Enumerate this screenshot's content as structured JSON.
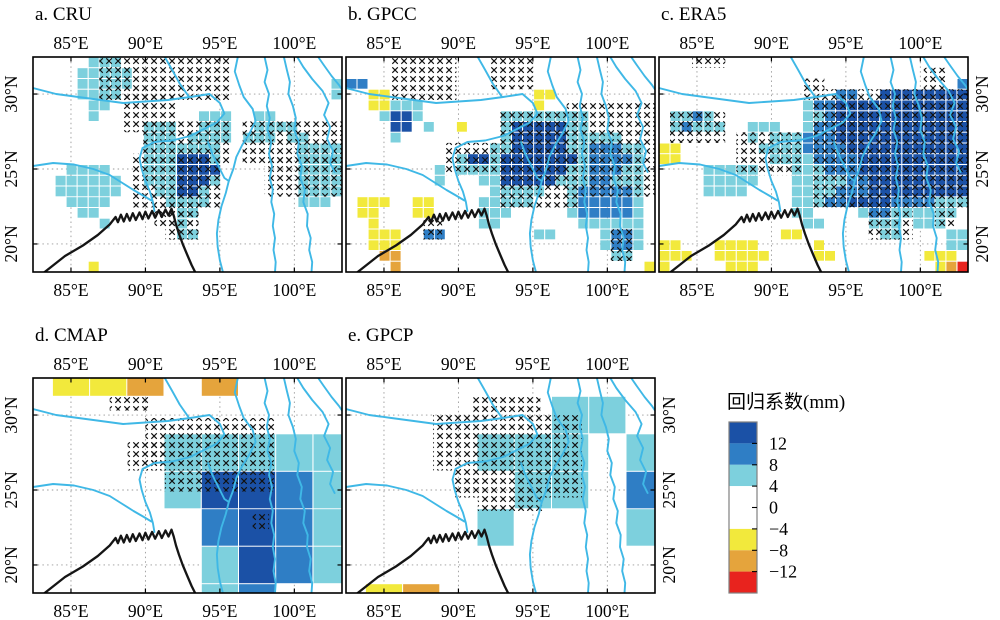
{
  "figure": {
    "width": 1000,
    "height": 620,
    "background": "#ffffff"
  },
  "layout": {
    "panel_size": [
      309,
      215
    ],
    "panels": [
      {
        "id": "a",
        "origin": [
          33,
          57
        ],
        "lat_labels": "left"
      },
      {
        "id": "b",
        "origin": [
          346,
          57
        ],
        "lat_labels": "none"
      },
      {
        "id": "c",
        "origin": [
          659,
          57
        ],
        "lat_labels": "right"
      },
      {
        "id": "d",
        "origin": [
          33,
          378
        ],
        "lat_labels": "left"
      },
      {
        "id": "e",
        "origin": [
          346,
          378
        ],
        "lat_labels": "right"
      }
    ],
    "legend": {
      "title_xy": [
        727,
        408
      ],
      "bar": [
        729,
        422,
        28,
        171
      ],
      "label_x": 769
    }
  },
  "chart_data": {
    "type": "heatmap",
    "subtype": "gridded geographic regression-coefficient maps with significance x-hatching",
    "variable": "回归系数(mm)",
    "extent": {
      "lon": [
        82.45,
        103.2
      ],
      "lat": [
        18.13,
        32.47
      ]
    },
    "lon_ticks": [
      {
        "deg": 85,
        "label": "85°E"
      },
      {
        "deg": 90,
        "label": "90°E"
      },
      {
        "deg": 95,
        "label": "95°E"
      },
      {
        "deg": 100,
        "label": "100°E"
      }
    ],
    "lat_ticks": [
      {
        "deg": 30,
        "label": "30°N"
      },
      {
        "deg": 25,
        "label": "25°N"
      },
      {
        "deg": 20,
        "label": "20°N"
      }
    ],
    "colorbar": {
      "title": "回归系数(mm)",
      "tick_labels": [
        "12",
        "8",
        "4",
        "0",
        "−4",
        "−8",
        "−12"
      ],
      "tick_values": [
        12,
        8,
        4,
        0,
        -4,
        -8,
        -12
      ],
      "segments_top_to_bottom": [
        "darkblue",
        "blue",
        "cyan",
        "white",
        "yellow",
        "orange",
        "red"
      ],
      "white_segment_double_height": true,
      "border_color": "#808080"
    },
    "palette": {
      "darkblue": "#1b51a6",
      "blue": "#2f7ec5",
      "cyan": "#7dd0dd",
      "white": "#ffffff",
      "yellow": "#f2e93c",
      "orange": "#e5a43c",
      "red": "#e8231e"
    },
    "cell_codes": {
      "B": "darkblue",
      "b": "blue",
      "c": "cyan",
      "y": "yellow",
      "o": "orange",
      "r": "red",
      ".": "white"
    },
    "panels": [
      {
        "label": "a. CRU",
        "dataset": "CRU",
        "grid": {
          "lon0": 82.45,
          "dlon": 0.7411,
          "lat0": 32.47,
          "dlat": 0.717,
          "rows": [
            ".....ccc....................",
            "....ccccc...................",
            "....ccccc..................c",
            "....cccc...................c",
            ".....cc.....................",
            ".....c.........ccc..cc......",
            "..........ccc..ccc..cccc....",
            "..........ccc.cccc.ccc.cc...",
            "..........ccccccc.......cccc",
            "..........cccBBBc.......cccc",
            "...cccc...cccBBBB.......cccc",
            "..cccccc..cccBBBc.......cccc",
            "..cccccc...ccBBc........cccc",
            "...cccc.....cccc........ccc.",
            "....cc.......cc.............",
            "......c......c..............",
            ".............cc.............",
            "............................",
            "............................",
            ".....y......................"
          ]
        },
        "hatch": [
          [
            86.9,
            32.47,
            95.79,
            29.6
          ],
          [
            88.38,
            30.32,
            92.08,
            27.45
          ],
          [
            89.86,
            28.17,
            95.79,
            25.3
          ],
          [
            89.12,
            26.02,
            95.05,
            22.44
          ],
          [
            90.6,
            23.15,
            93.56,
            21.01
          ],
          [
            96.53,
            28.17,
            103.2,
            25.3
          ],
          [
            98.01,
            26.02,
            103.2,
            23.16
          ],
          [
            91.34,
            22.44,
            93.56,
            20.29
          ]
        ]
      },
      {
        "label": "b. GPCC",
        "dataset": "GPCC",
        "grid": {
          "lon0": 82.45,
          "dlon": 0.7411,
          "lat0": 32.47,
          "dlat": 0.717,
          "rows": [
            "............................",
            "............................",
            "bb..........................",
            "..yy.............yy.........",
            "..yyccc..........y..........",
            "...cBBc.......cccccccc......",
            "....BB.c..y...cBBBBBcc......",
            "....c.........cBBBBBccccc...",
            ".............ccBBBBBccbbbcc.",
            "..........cBBcBBBBBBBcbbbbc.",
            "........c.ccccBBBBBBccbbbcc.",
            "........c...ccBBBBBcccbbccc.",
            ".............ccccc..cbbbbbc.",
            ".yyy..yy....ccccc...cbbbbbc.",
            ".yy...yy....ccc.....cbbbbbc.",
            "..y.........cc.......cccccc.",
            "..yyy..bb........cc....cbbc.",
            "..yyy..................cbbc.",
            "...oo...................cc..",
            "....o......................y"
          ]
        },
        "hatch": [
          [
            85.41,
            32.47,
            89.86,
            29.6
          ],
          [
            92.08,
            32.47,
            95.05,
            30.32
          ],
          [
            89.12,
            26.74,
            92.82,
            24.59
          ],
          [
            92.82,
            28.89,
            98.01,
            22.44
          ],
          [
            97.27,
            29.6,
            103.2,
            23.16
          ],
          [
            100.23,
            21.01,
            101.71,
            18.86
          ],
          [
            87.64,
            21.72,
            88.9,
            20.29
          ]
        ]
      },
      {
        "label": "c. ERA5",
        "dataset": "ERA5",
        "grid": {
          "lon0": 82.45,
          "dlon": 0.7411,
          "lat0": 32.47,
          "dlat": 0.717,
          "rows": [
            "............................",
            "............................",
            "...........................b",
            "................bb..BBBBBBBB",
            ".............cbbBBBBBBBBBBBB",
            ".ccbc........ccbBBBBBBBBBBBB",
            ".cbccc..ccc..cbbBBBBBBBBBBBB",
            "........c.cccbbbBBBBBBBBBBBB",
            "yy.......ccccbbbbBBBBBBBBBBB",
            "yy........ccccbbbbBBBBBBBBBB",
            "....ccccc...cccbbbBBBBBBBBBB",
            "....ccccc...cccccbbBBBBBBBBB",
            "....cccc....ccccbbbBBBBBBBBB",
            "............cccbbBBBBbbbbccc",
            "............cc....cbbcccccc.",
            ".............cc....ccc.ccc..",
            "...........yy.......cc....cc",
            "yy...yyyy.....y...........cc",
            "yyy..yyyyy....yy........yyy.",
            "y.....yyy................yor"
          ]
        },
        "hatch": [
          [
            84.67,
            32.47,
            86.9,
            31.75
          ],
          [
            100.23,
            31.75,
            101.71,
            30.32
          ],
          [
            92.08,
            31.03,
            93.56,
            29.6
          ],
          [
            83.19,
            28.89,
            86.9,
            26.74
          ],
          [
            87.64,
            27.45,
            92.08,
            24.59
          ],
          [
            92.82,
            30.32,
            103.2,
            22.44
          ],
          [
            96.53,
            22.44,
            99.49,
            20.29
          ],
          [
            100.97,
            22.44,
            102.45,
            21.01
          ]
        ]
      },
      {
        "label": "d. CMAP",
        "dataset": "CMAP",
        "grid": {
          "lon_edges": [
            82.45,
            83.75,
            86.25,
            88.75,
            91.25,
            93.75,
            96.25,
            98.75,
            101.25,
            103.2
          ],
          "lat_edges": [
            32.47,
            31.25,
            28.75,
            26.25,
            23.75,
            21.25,
            18.75,
            18.13
          ],
          "rows": [
            ".yyo.o...",
            ".........",
            "....ccccc",
            "....cBBbc",
            ".....bBbc",
            ".....cBbc",
            ".....cb.."
          ]
        },
        "hatch": [
          [
            87.6,
            31.2,
            90.3,
            30.3
          ],
          [
            90.0,
            29.8,
            98.7,
            26.3
          ],
          [
            88.8,
            28.2,
            91.3,
            26.3
          ],
          [
            91.3,
            26.25,
            98.75,
            24.9
          ],
          [
            97.2,
            23.5,
            98.3,
            22.3
          ]
        ]
      },
      {
        "label": "e. GPCP",
        "dataset": "GPCP",
        "grid": {
          "lon_edges": [
            82.45,
            83.75,
            86.25,
            88.75,
            91.25,
            93.75,
            96.25,
            98.75,
            101.25,
            103.2
          ],
          "lat_edges": [
            32.47,
            31.25,
            28.75,
            26.25,
            23.75,
            21.25,
            18.75,
            18.13
          ],
          "rows": [
            ".........",
            "......cc.",
            "....ccc.c",
            ".....cc.b",
            "....c...c",
            ".........",
            ".yo......"
          ]
        },
        "hatch": [
          [
            91.0,
            31.2,
            95.5,
            30.0
          ],
          [
            88.3,
            30.0,
            98.3,
            26.3
          ],
          [
            89.7,
            26.3,
            98.3,
            24.5
          ],
          [
            91.3,
            24.5,
            95.7,
            23.6
          ]
        ]
      }
    ],
    "geo": {
      "rivers_color": "#3fb8e6",
      "coast_color": "#151515",
      "grid_color": "#9a9a9a",
      "coast": [
        [
          82.45,
          17.6
        ],
        [
          83.2,
          18.1
        ],
        [
          84.6,
          19.2
        ],
        [
          85.8,
          19.9
        ],
        [
          86.8,
          20.6
        ],
        [
          87.6,
          21.3
        ],
        [
          88.0,
          21.8
        ],
        [
          88.15,
          21.45
        ],
        [
          88.35,
          21.95
        ],
        [
          88.55,
          21.5
        ],
        [
          88.75,
          22.0
        ],
        [
          88.95,
          21.55
        ],
        [
          89.15,
          22.05
        ],
        [
          89.35,
          21.6
        ],
        [
          89.6,
          22.1
        ],
        [
          89.8,
          21.65
        ],
        [
          90.0,
          22.15
        ],
        [
          90.2,
          21.7
        ],
        [
          90.45,
          22.2
        ],
        [
          90.65,
          21.75
        ],
        [
          90.9,
          22.25
        ],
        [
          91.1,
          21.8
        ],
        [
          91.35,
          22.3
        ],
        [
          91.55,
          21.9
        ],
        [
          91.75,
          22.35
        ],
        [
          91.9,
          21.9
        ],
        [
          92.05,
          21.3
        ],
        [
          92.25,
          20.7
        ],
        [
          92.5,
          20.0
        ],
        [
          92.8,
          19.3
        ],
        [
          93.1,
          18.6
        ],
        [
          93.35,
          18.1
        ],
        [
          93.5,
          17.7
        ]
      ],
      "rivers": [
        [
          [
            82.45,
            30.4
          ],
          [
            84.0,
            30.0
          ],
          [
            85.5,
            29.8
          ],
          [
            87.0,
            29.6
          ],
          [
            88.5,
            29.4
          ],
          [
            90.0,
            29.5
          ],
          [
            91.5,
            29.6
          ],
          [
            93.0,
            29.8
          ],
          [
            94.3,
            30.0
          ],
          [
            95.0,
            29.4
          ],
          [
            95.3,
            28.7
          ],
          [
            94.8,
            28.1
          ],
          [
            94.0,
            27.7
          ],
          [
            93.0,
            27.2
          ],
          [
            91.8,
            26.9
          ],
          [
            90.6,
            26.8
          ],
          [
            89.8,
            26.4
          ],
          [
            89.6,
            25.7
          ],
          [
            89.75,
            25.0
          ],
          [
            90.0,
            24.2
          ],
          [
            90.3,
            23.5
          ],
          [
            90.5,
            22.8
          ],
          [
            90.6,
            22.2
          ]
        ],
        [
          [
            82.45,
            25.2
          ],
          [
            83.8,
            25.4
          ],
          [
            85.2,
            25.3
          ],
          [
            86.5,
            25.0
          ],
          [
            87.6,
            24.6
          ],
          [
            88.4,
            24.1
          ],
          [
            89.2,
            23.6
          ],
          [
            89.9,
            23.2
          ],
          [
            90.4,
            22.9
          ]
        ],
        [
          [
            91.3,
            32.47
          ],
          [
            91.8,
            31.6
          ],
          [
            92.3,
            30.7
          ],
          [
            92.9,
            29.85
          ]
        ],
        [
          [
            96.2,
            32.47
          ],
          [
            96.0,
            31.5
          ],
          [
            96.3,
            30.6
          ],
          [
            96.6,
            29.8
          ],
          [
            97.2,
            29.0
          ],
          [
            97.4,
            28.2
          ],
          [
            97.0,
            27.4
          ],
          [
            96.5,
            26.6
          ],
          [
            96.1,
            25.8
          ],
          [
            95.9,
            25.0
          ],
          [
            95.6,
            24.2
          ],
          [
            95.4,
            23.4
          ],
          [
            95.1,
            22.5
          ],
          [
            94.9,
            21.6
          ],
          [
            94.8,
            20.7
          ],
          [
            94.85,
            19.8
          ],
          [
            95.0,
            18.9
          ],
          [
            95.2,
            18.13
          ]
        ],
        [
          [
            94.2,
            26.8
          ],
          [
            94.5,
            26.0
          ],
          [
            94.9,
            25.2
          ],
          [
            95.3,
            24.4
          ],
          [
            95.6,
            24.2
          ]
        ],
        [
          [
            98.0,
            32.47
          ],
          [
            98.2,
            31.6
          ],
          [
            98.0,
            30.8
          ],
          [
            98.3,
            30.0
          ],
          [
            98.15,
            29.2
          ],
          [
            98.35,
            28.4
          ],
          [
            98.2,
            27.6
          ],
          [
            98.45,
            26.8
          ],
          [
            98.3,
            26.0
          ],
          [
            98.5,
            25.2
          ],
          [
            98.35,
            24.4
          ],
          [
            98.55,
            23.6
          ],
          [
            98.45,
            22.8
          ],
          [
            98.65,
            22.0
          ],
          [
            98.55,
            21.2
          ],
          [
            98.7,
            20.4
          ],
          [
            98.6,
            19.6
          ],
          [
            98.75,
            18.8
          ],
          [
            98.7,
            18.13
          ]
        ],
        [
          [
            99.3,
            32.47
          ],
          [
            99.5,
            31.6
          ],
          [
            99.7,
            30.8
          ],
          [
            99.6,
            30.0
          ],
          [
            99.9,
            29.2
          ],
          [
            100.1,
            28.4
          ],
          [
            100.0,
            27.6
          ],
          [
            100.3,
            26.8
          ],
          [
            100.2,
            26.0
          ],
          [
            100.5,
            25.2
          ],
          [
            100.4,
            24.4
          ],
          [
            100.7,
            23.6
          ],
          [
            100.6,
            22.8
          ],
          [
            100.9,
            22.0
          ],
          [
            100.85,
            21.2
          ],
          [
            101.1,
            20.4
          ],
          [
            101.0,
            19.6
          ],
          [
            101.2,
            18.8
          ],
          [
            101.15,
            18.13
          ]
        ],
        [
          [
            100.2,
            32.47
          ],
          [
            100.6,
            31.8
          ],
          [
            101.2,
            31.0
          ],
          [
            101.9,
            30.2
          ],
          [
            102.3,
            29.4
          ],
          [
            102.0,
            28.6
          ],
          [
            102.4,
            27.8
          ],
          [
            102.2,
            27.0
          ],
          [
            102.6,
            26.2
          ],
          [
            102.4,
            25.4
          ],
          [
            102.7,
            24.8
          ]
        ],
        [
          [
            101.6,
            32.47
          ],
          [
            102.0,
            31.9
          ],
          [
            102.5,
            31.2
          ],
          [
            103.0,
            30.6
          ],
          [
            103.2,
            30.3
          ]
        ]
      ]
    }
  }
}
